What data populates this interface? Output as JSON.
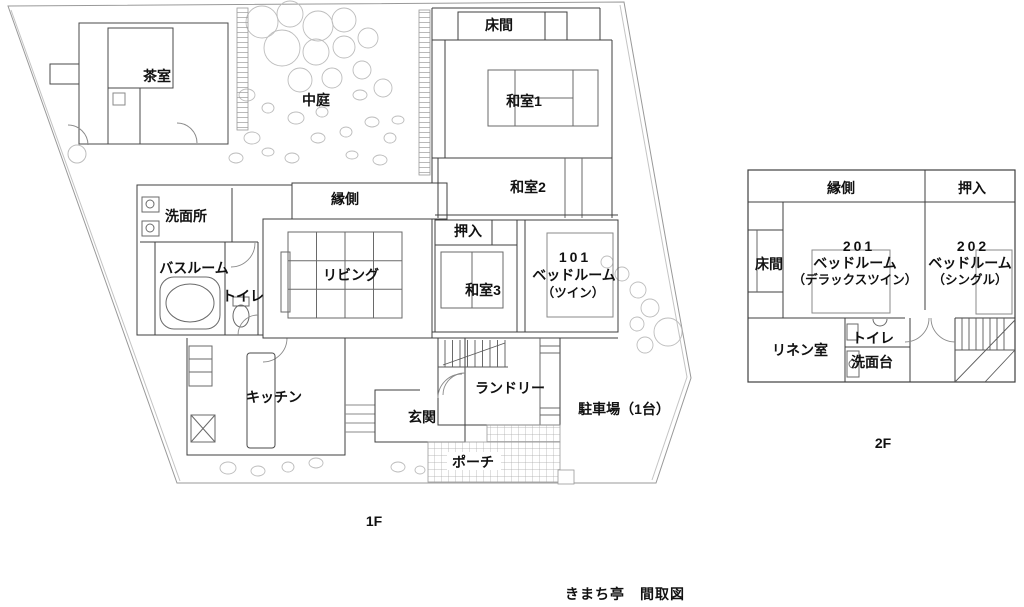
{
  "title": "きまち亭　間取図",
  "colors": {
    "wall": "#3f3f3f",
    "detail": "#8a8a8a",
    "garden": "#bdbdbd",
    "hatch": "#a8a8a8",
    "text": "#111111",
    "background": "#ffffff"
  },
  "floor1": {
    "floor_label": "1F",
    "rooms": {
      "chashitsu": "茶室",
      "nakaniwa": "中庭",
      "tokonoma": "床間",
      "washitsu1": "和室1",
      "washitsu2": "和室2",
      "engawa": "縁側",
      "senmenjo": "洗面所",
      "bathroom": "バスルーム",
      "toilet": "トイレ",
      "living": "リビング",
      "oshiire": "押入",
      "washitsu3": "和室3",
      "kitchen": "キッチン",
      "genkan": "玄関",
      "laundry": "ランドリー",
      "porch": "ポーチ",
      "parking": "駐車場（1台）"
    },
    "room101": {
      "number": "101",
      "type": "ベッドルーム",
      "variant": "（ツイン）"
    }
  },
  "floor2": {
    "floor_label": "2F",
    "rooms": {
      "engawa": "縁側",
      "oshiire": "押入",
      "tokonoma": "床間",
      "linen": "リネン室",
      "toilet": "トイレ",
      "senmendai": "洗面台"
    },
    "room201": {
      "number": "201",
      "type": "ベッドルーム",
      "variant": "（デラックスツイン）"
    },
    "room202": {
      "number": "202",
      "type": "ベッドルーム",
      "variant": "（シングル）"
    }
  }
}
